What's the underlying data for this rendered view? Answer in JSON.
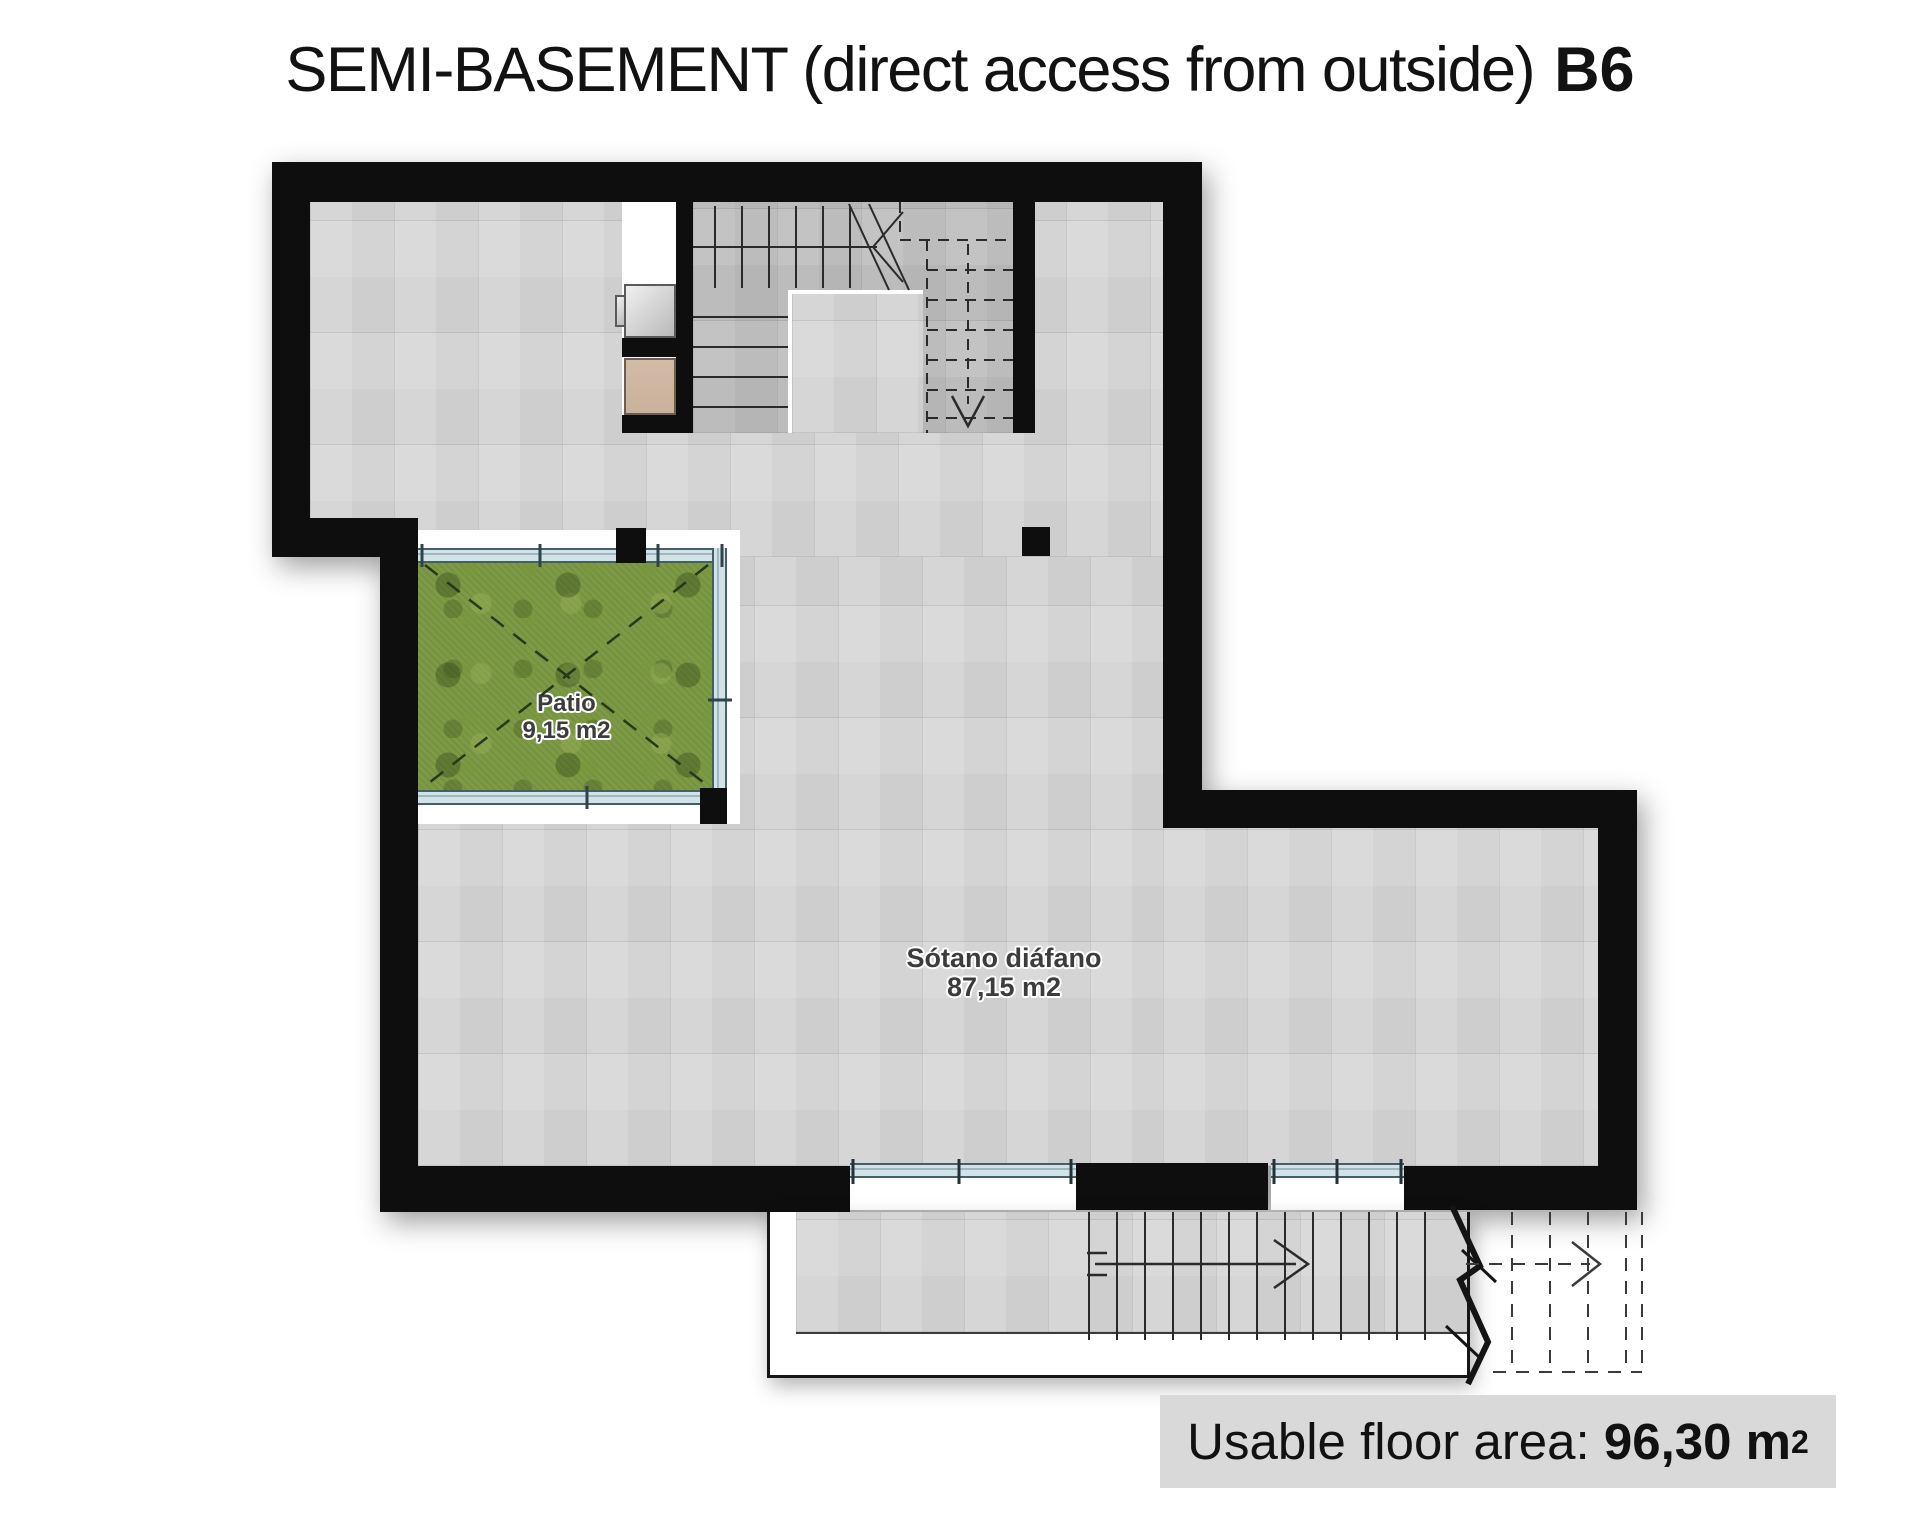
{
  "title": {
    "text": "SEMI-BASEMENT (direct access from outside)",
    "code": "B6"
  },
  "rooms": {
    "patio": {
      "name": "Patio",
      "area": "9,15 m2"
    },
    "sotano": {
      "name": "Sótano diáfano",
      "area": "87,15 m2"
    }
  },
  "footer": {
    "label": "Usable floor area: ",
    "value": "96,30 m",
    "sup": "2"
  },
  "colors": {
    "wall": "#0e0e0e",
    "floor": "#d6d6d6",
    "floor_dark": "#bcbcbc",
    "grass": "#7d9a45",
    "glazing": "#d3e2e6",
    "glazing_line": "#42606a",
    "tan": "#c9b29c",
    "box_bg": "#d9d9d9",
    "label": "#3c3c3c"
  }
}
